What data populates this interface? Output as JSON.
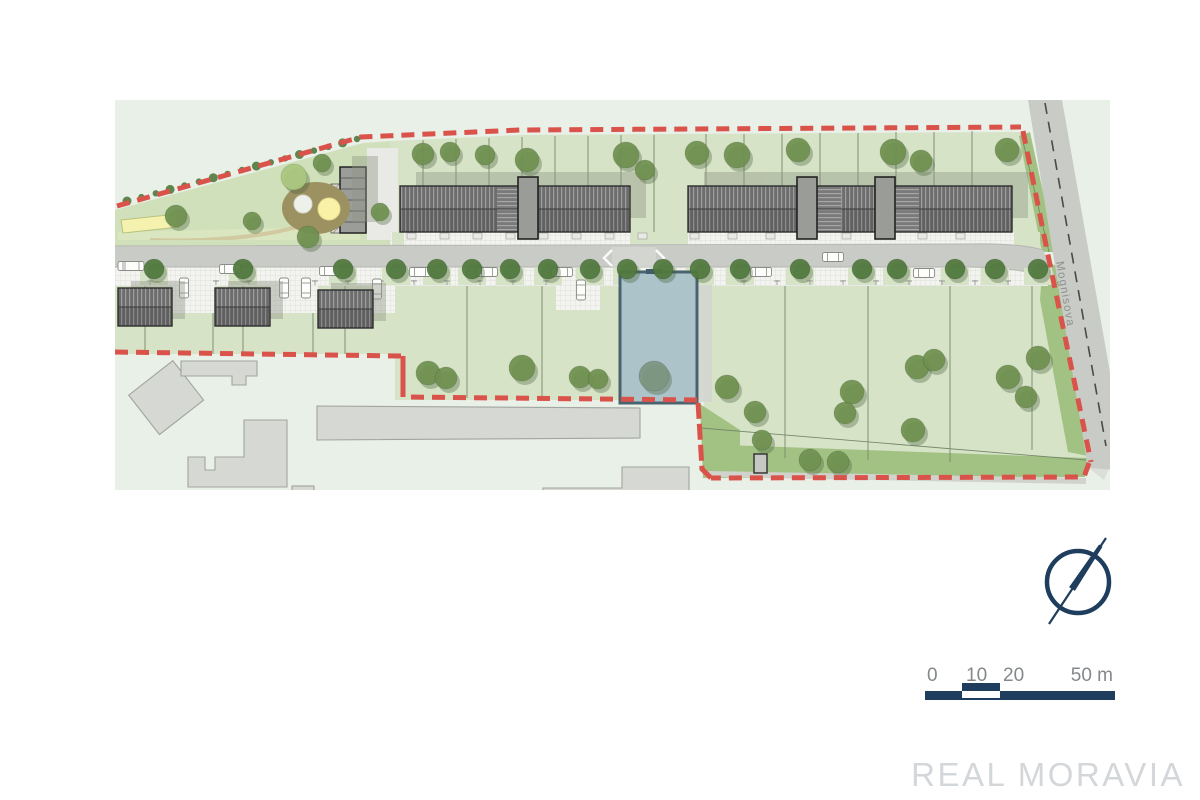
{
  "watermark": {
    "text": "REAL MORAVIA"
  },
  "street": {
    "label": "Mognisova"
  },
  "scalebar": {
    "labels": [
      "0",
      "10",
      "20",
      "50 m"
    ],
    "ticks_m": [
      0,
      10,
      20,
      50
    ],
    "unit": "m"
  },
  "compass": {
    "icon": "north-arrow-icon"
  },
  "colors": {
    "base": "#e9f0e8",
    "park": "#cfe0ba",
    "parcel": "#d6e3c6",
    "buffer": "#a2c284",
    "road": "#c9cbc7",
    "sidewalk": "#f3f4f0",
    "roof": "#6d6d6d",
    "roofLine": "#9e9e9e",
    "outline": "#2e2e2e",
    "existing": "#d6d8d3",
    "existingStroke": "#a2a4a0",
    "boundary": "#d9534b",
    "plotFill": "#a9c2ca",
    "plotStroke": "#415d6b",
    "tree": "#6f9150",
    "treeStreet": "#50793d",
    "treeLight": "#aac77e",
    "treeBlue": "#7d9681",
    "treeShadow": "#49603a",
    "navy": "#1f3d5d",
    "label": "#85888b",
    "watermark": "#d4d7da",
    "street": "#8f918c",
    "yellow": "#f4f2ae",
    "playground": "#9c9161",
    "sand": "#f8f1a6"
  },
  "map_data": {
    "trees": [
      {
        "x": 176,
        "y": 216,
        "r": 11,
        "t": "p"
      },
      {
        "x": 252,
        "y": 221,
        "r": 9,
        "t": "p"
      },
      {
        "x": 294,
        "y": 177,
        "r": 13,
        "t": "l"
      },
      {
        "x": 322,
        "y": 163,
        "r": 9,
        "t": "p"
      },
      {
        "x": 308,
        "y": 237,
        "r": 11,
        "t": "p"
      },
      {
        "x": 380,
        "y": 212,
        "r": 9,
        "t": "p"
      },
      {
        "x": 423,
        "y": 154,
        "r": 11,
        "t": "p"
      },
      {
        "x": 450,
        "y": 152,
        "r": 10,
        "t": "p"
      },
      {
        "x": 485,
        "y": 155,
        "r": 10,
        "t": "p"
      },
      {
        "x": 527,
        "y": 160,
        "r": 12,
        "t": "p"
      },
      {
        "x": 626,
        "y": 155,
        "r": 13,
        "t": "p"
      },
      {
        "x": 645,
        "y": 170,
        "r": 10,
        "t": "p"
      },
      {
        "x": 697,
        "y": 153,
        "r": 12,
        "t": "p"
      },
      {
        "x": 737,
        "y": 155,
        "r": 13,
        "t": "p"
      },
      {
        "x": 798,
        "y": 150,
        "r": 12,
        "t": "p"
      },
      {
        "x": 893,
        "y": 152,
        "r": 13,
        "t": "p"
      },
      {
        "x": 921,
        "y": 161,
        "r": 11,
        "t": "p"
      },
      {
        "x": 1007,
        "y": 150,
        "r": 12,
        "t": "p"
      },
      {
        "x": 428,
        "y": 373,
        "r": 12,
        "t": "p"
      },
      {
        "x": 446,
        "y": 378,
        "r": 11,
        "t": "p"
      },
      {
        "x": 522,
        "y": 368,
        "r": 13,
        "t": "p"
      },
      {
        "x": 580,
        "y": 377,
        "r": 11,
        "t": "p"
      },
      {
        "x": 598,
        "y": 379,
        "r": 10,
        "t": "p"
      },
      {
        "x": 654,
        "y": 376,
        "r": 15,
        "t": "b"
      },
      {
        "x": 727,
        "y": 387,
        "r": 12,
        "t": "p"
      },
      {
        "x": 755,
        "y": 412,
        "r": 11,
        "t": "p"
      },
      {
        "x": 762,
        "y": 440,
        "r": 10,
        "t": "p"
      },
      {
        "x": 810,
        "y": 460,
        "r": 11,
        "t": "p"
      },
      {
        "x": 838,
        "y": 462,
        "r": 11,
        "t": "p"
      },
      {
        "x": 852,
        "y": 392,
        "r": 12,
        "t": "p"
      },
      {
        "x": 845,
        "y": 413,
        "r": 11,
        "t": "p"
      },
      {
        "x": 917,
        "y": 367,
        "r": 12,
        "t": "p"
      },
      {
        "x": 934,
        "y": 360,
        "r": 11,
        "t": "p"
      },
      {
        "x": 913,
        "y": 430,
        "r": 12,
        "t": "p"
      },
      {
        "x": 1008,
        "y": 377,
        "r": 12,
        "t": "p"
      },
      {
        "x": 1026,
        "y": 397,
        "r": 11,
        "t": "p"
      },
      {
        "x": 1038,
        "y": 358,
        "r": 12,
        "t": "p"
      }
    ],
    "street_trees_y": 269,
    "street_trees_x": [
      154,
      243,
      343,
      396,
      437,
      472,
      510,
      548,
      590,
      627,
      663,
      700,
      740,
      800,
      862,
      897,
      955,
      995,
      1038
    ],
    "cars_h": [
      {
        "x": 131,
        "y": 266,
        "bus": true
      },
      {
        "x": 230,
        "y": 269
      },
      {
        "x": 330,
        "y": 271
      },
      {
        "x": 420,
        "y": 272
      },
      {
        "x": 487,
        "y": 272
      },
      {
        "x": 562,
        "y": 272
      },
      {
        "x": 761,
        "y": 272
      },
      {
        "x": 833,
        "y": 257
      },
      {
        "x": 924,
        "y": 273
      }
    ],
    "cars_v": [
      {
        "x": 184,
        "y": 288
      },
      {
        "x": 284,
        "y": 288
      },
      {
        "x": 306,
        "y": 288
      },
      {
        "x": 377,
        "y": 289
      },
      {
        "x": 581,
        "y": 290
      }
    ],
    "parcel_lines": [
      [
        423,
        140,
        423,
        250
      ],
      [
        456,
        139,
        456,
        250
      ],
      [
        489,
        138,
        489,
        250
      ],
      [
        522,
        137,
        522,
        250
      ],
      [
        555,
        136,
        555,
        250
      ],
      [
        588,
        136,
        588,
        250
      ],
      [
        621,
        135,
        621,
        250
      ],
      [
        654,
        135,
        654,
        250
      ],
      [
        706,
        134,
        706,
        250
      ],
      [
        744,
        134,
        744,
        250
      ],
      [
        782,
        134,
        782,
        250
      ],
      [
        820,
        133,
        820,
        250
      ],
      [
        858,
        133,
        858,
        250
      ],
      [
        896,
        132,
        896,
        250
      ],
      [
        934,
        132,
        934,
        250
      ],
      [
        972,
        131,
        972,
        250
      ],
      [
        1021,
        133,
        1049,
        252
      ],
      [
        467,
        286,
        467,
        398
      ],
      [
        542,
        286,
        542,
        398
      ],
      [
        785,
        284,
        785,
        458
      ],
      [
        868,
        282,
        868,
        460
      ],
      [
        950,
        280,
        950,
        462
      ],
      [
        1032,
        278,
        1032,
        450
      ],
      [
        213,
        286,
        213,
        354
      ],
      [
        313,
        286,
        313,
        354
      ],
      [
        145,
        270,
        145,
        353
      ],
      [
        243,
        270,
        243,
        353
      ],
      [
        345,
        270,
        345,
        354
      ],
      [
        701,
        428,
        1086,
        460
      ]
    ],
    "porch_x": [
      423,
      456,
      489,
      522,
      555,
      588,
      621,
      654,
      706,
      744,
      782,
      820,
      858,
      896,
      934,
      972
    ],
    "bush_line": {
      "x1": 127,
      "y1": 201,
      "x2": 357,
      "y2": 139,
      "n": 17
    }
  }
}
